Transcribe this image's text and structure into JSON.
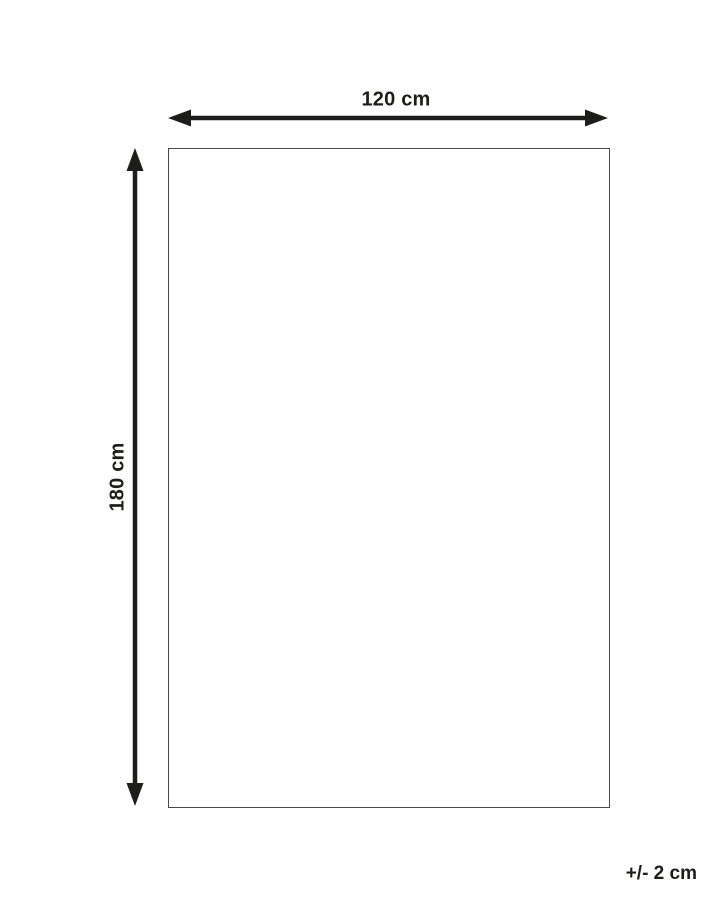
{
  "diagram": {
    "type": "product-dimension-diagram",
    "width_label": "120 cm",
    "height_label": "180 cm",
    "tolerance_label": "+/- 2 cm",
    "dimensions": {
      "width_cm": 120,
      "height_cm": 180,
      "tolerance_cm": 2
    },
    "colors": {
      "arrow": "#1d1d1b",
      "text": "#1d1d1b",
      "outline_border": "#4a4a4a",
      "background": "#ffffff"
    }
  }
}
